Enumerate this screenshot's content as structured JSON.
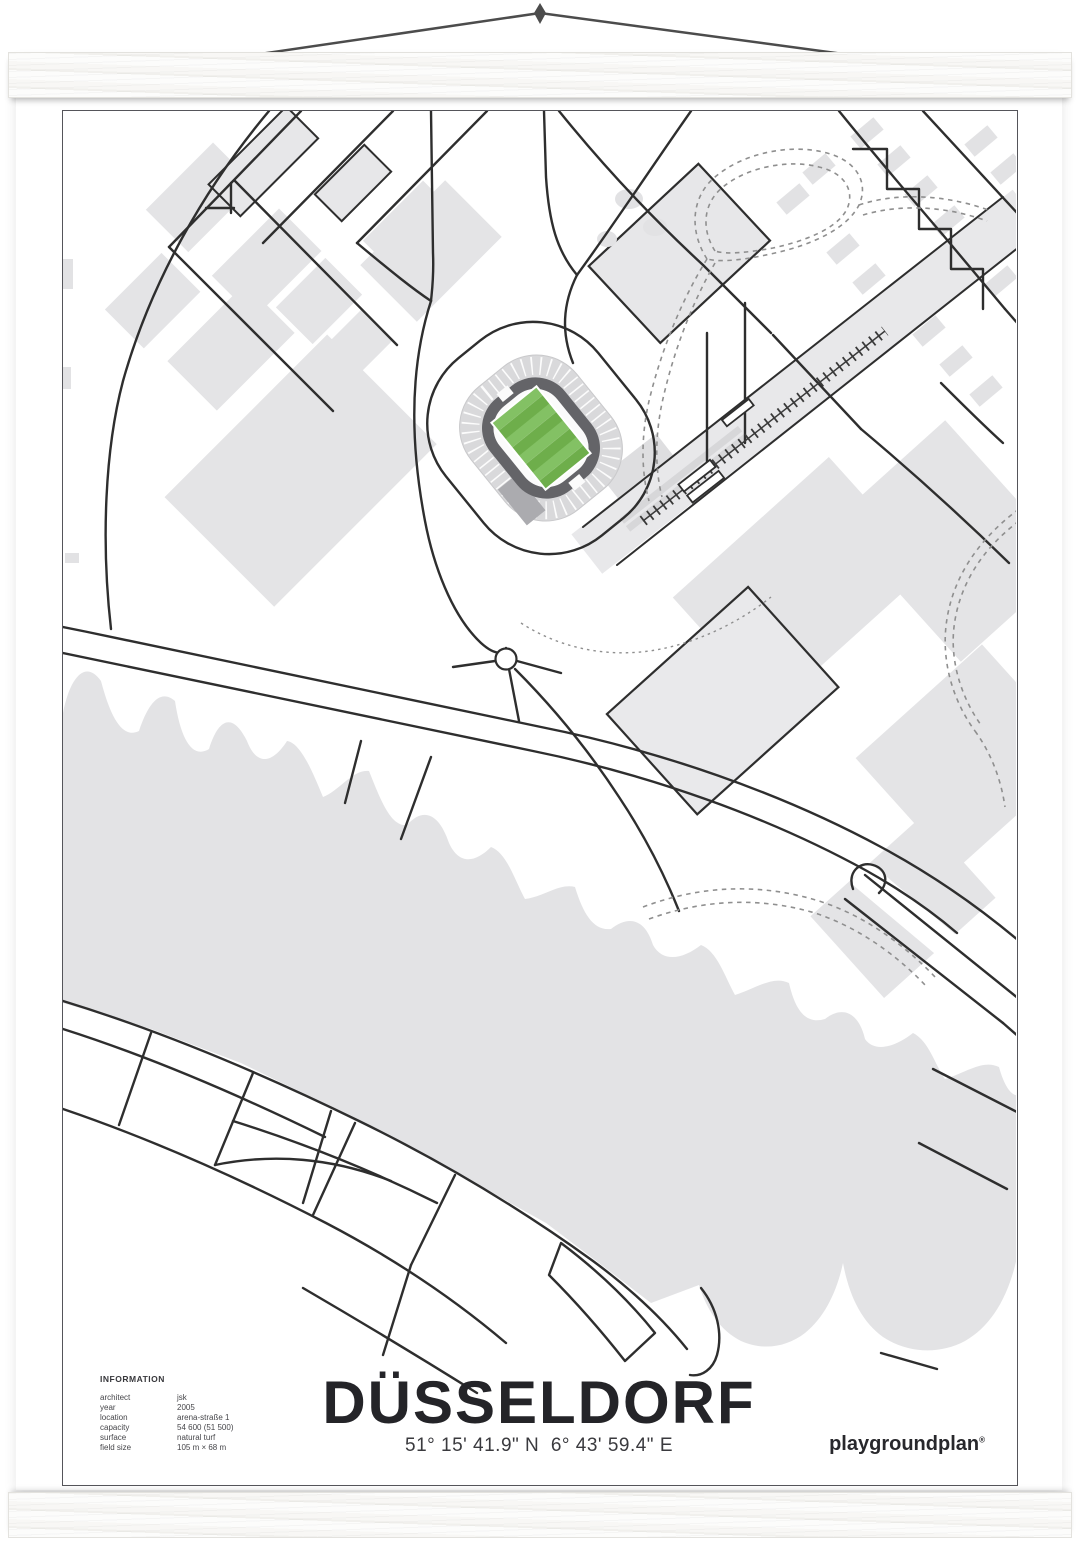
{
  "poster": {
    "title": "DÜSSELDORF",
    "coordinates": "51° 15' 41.9\" N  6° 43' 59.4\" E",
    "info": {
      "heading": "INFORMATION",
      "rows": [
        {
          "label": "architect",
          "value": "jsk"
        },
        {
          "label": "year",
          "value": "2005"
        },
        {
          "label": "location",
          "value": "arena-straße 1"
        },
        {
          "label": "capacity",
          "value": "54 600 (51 500)"
        },
        {
          "label": "surface",
          "value": "natural turf"
        },
        {
          "label": "field size",
          "value": "105 m × 68 m"
        }
      ]
    },
    "brand": {
      "name": "playgroundplan",
      "mark": "®"
    }
  },
  "map": {
    "colors": {
      "road": "#2e2e2e",
      "building": "#e4e4e6",
      "water": "#e3e3e5",
      "stand_ring": "#d9d9db",
      "roof_ring": "#646468",
      "pitch_light": "#83c164",
      "pitch_dark": "#6eae4b"
    }
  }
}
